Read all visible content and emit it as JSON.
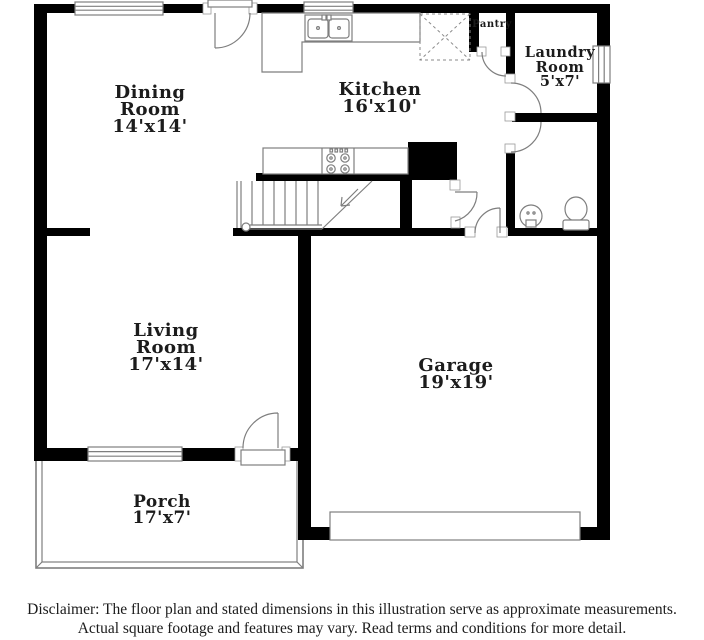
{
  "plan": {
    "rooms": {
      "dining": {
        "name_line1": "Dining",
        "name_line2": "Room",
        "dims": "14'x14'"
      },
      "kitchen": {
        "name_line1": "Kitchen",
        "dims": "16'x10'"
      },
      "laundry": {
        "name_line1": "Laundry",
        "name_line2": "Room",
        "dims": "5'x7'"
      },
      "pantry": {
        "name_line1": "Pantry"
      },
      "living": {
        "name_line1": "Living",
        "name_line2": "Room",
        "dims": "17'x14'"
      },
      "garage": {
        "name_line1": "Garage",
        "dims": "19'x19'"
      },
      "porch": {
        "name_line1": "Porch",
        "dims": "17'x7'"
      }
    },
    "colors": {
      "wall": "#000000",
      "thin_line": "#7e7e7e",
      "text": "#1c1c1c",
      "background": "#ffffff"
    }
  },
  "disclaimer": {
    "line1": "Disclaimer: The floor plan and stated dimensions in this illustration serve as approximate measurements.",
    "line2": "Actual square footage and features may vary. Read terms and conditions for more detail."
  }
}
